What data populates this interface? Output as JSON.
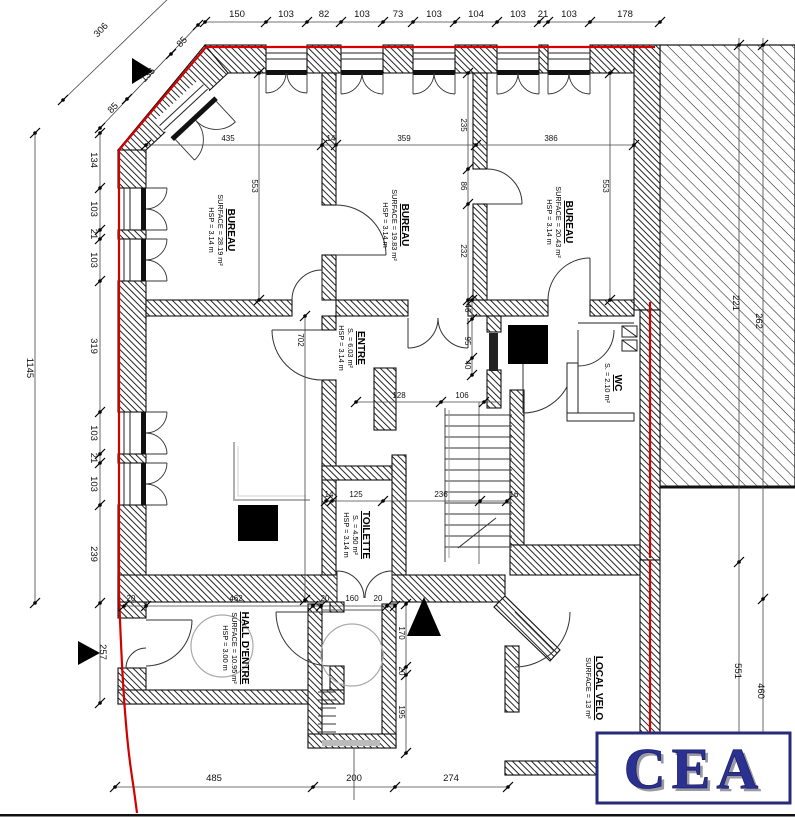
{
  "logo": {
    "text": "CEA",
    "color": "#2b3191",
    "border_color": "#272b7a",
    "shadow_color": "#9a9aa6"
  },
  "accent_colors": {
    "boundary_red": "#d40000",
    "line_black": "#111111"
  },
  "rooms": [
    {
      "id": "bureau-1",
      "name": "BUREAU",
      "line2": "SURFACE = 28.19 m²",
      "line3": "HSP = 3.14 m",
      "x": 228,
      "y": 230
    },
    {
      "id": "bureau-2",
      "name": "BUREAU",
      "line2": "SURFACE = 19.83 m²",
      "line3": "HSP = 3.14 m",
      "x": 402,
      "y": 225
    },
    {
      "id": "bureau-3",
      "name": "BUREAU",
      "line2": "SURFACE = 20.43 m²",
      "line3": "HSP = 3.14 m",
      "x": 566,
      "y": 222
    },
    {
      "id": "entre",
      "name": "ENTRE",
      "line2": "S. = 6.03 m²",
      "line3": "HSP = 3.14 m",
      "x": 358,
      "y": 348
    },
    {
      "id": "wc",
      "name": "WC",
      "line2": "S. = 2.10 m²",
      "line3": "",
      "x": 615,
      "y": 383
    },
    {
      "id": "toilette",
      "name": "TOILETTE",
      "line2": "S. = 4.50 m²",
      "line3": "HSP = 3.14 m",
      "x": 363,
      "y": 535
    },
    {
      "id": "hall-entre",
      "name": "HALL D'ENTRE",
      "line2": "SURFACE = 10.95 m²",
      "line3": "HSP = 3.00 m",
      "x": 242,
      "y": 648
    },
    {
      "id": "local-velo",
      "name": "LOCAL VELO",
      "line2": "SURFACE = 13 m²",
      "line3": "",
      "x": 596,
      "y": 688
    }
  ],
  "dim_labels": {
    "top": [
      {
        "t": "150",
        "x": 237,
        "y": 17
      },
      {
        "t": "103",
        "x": 286,
        "y": 17
      },
      {
        "t": "82",
        "x": 324,
        "y": 17
      },
      {
        "t": "103",
        "x": 362,
        "y": 17
      },
      {
        "t": "73",
        "x": 398,
        "y": 17
      },
      {
        "t": "103",
        "x": 434,
        "y": 17
      },
      {
        "t": "104",
        "x": 476,
        "y": 17
      },
      {
        "t": "103",
        "x": 518,
        "y": 17
      },
      {
        "t": "21",
        "x": 543,
        "y": 17
      },
      {
        "t": "103",
        "x": 569,
        "y": 17
      },
      {
        "t": "178",
        "x": 625,
        "y": 17
      }
    ],
    "left": [
      {
        "t": "134",
        "x": 91,
        "y": 160,
        "r": 90
      },
      {
        "t": "103",
        "x": 91,
        "y": 209,
        "r": 90
      },
      {
        "t": "21",
        "x": 91,
        "y": 234,
        "r": 90
      },
      {
        "t": "103",
        "x": 91,
        "y": 260,
        "r": 90
      },
      {
        "t": "319",
        "x": 91,
        "y": 346,
        "r": 90
      },
      {
        "t": "103",
        "x": 91,
        "y": 433,
        "r": 90
      },
      {
        "t": "21",
        "x": 91,
        "y": 458,
        "r": 90
      },
      {
        "t": "103",
        "x": 91,
        "y": 484,
        "r": 90
      },
      {
        "t": "239",
        "x": 91,
        "y": 554,
        "r": 90
      },
      {
        "t": "257",
        "x": 100,
        "y": 652,
        "r": 90
      },
      {
        "t": "1145",
        "x": 27,
        "y": 368,
        "r": 90
      }
    ],
    "diagonal": [
      {
        "t": "306",
        "x": 103,
        "y": 32,
        "r": -46
      },
      {
        "t": "85",
        "x": 184,
        "y": 44,
        "r": -46
      },
      {
        "t": "136",
        "x": 150,
        "y": 77,
        "r": -46
      },
      {
        "t": "85",
        "x": 115,
        "y": 110,
        "r": -46
      }
    ],
    "bottom": [
      {
        "t": "485",
        "x": 214,
        "y": 781
      },
      {
        "t": "200",
        "x": 354,
        "y": 781
      },
      {
        "t": "274",
        "x": 451,
        "y": 781
      }
    ],
    "right": [
      {
        "t": "221",
        "x": 733,
        "y": 303,
        "r": 90
      },
      {
        "t": "262",
        "x": 756,
        "y": 321,
        "r": 90
      },
      {
        "t": "551",
        "x": 735,
        "y": 671,
        "r": 90
      },
      {
        "t": "460",
        "x": 758,
        "y": 691,
        "r": 90
      }
    ],
    "interior": [
      {
        "t": "435",
        "x": 228,
        "y": 141
      },
      {
        "t": "14",
        "x": 331,
        "y": 141
      },
      {
        "t": "359",
        "x": 404,
        "y": 141
      },
      {
        "t": "386",
        "x": 551,
        "y": 141
      },
      {
        "t": "553",
        "x": 252,
        "y": 186,
        "r": 90
      },
      {
        "t": "553",
        "x": 603,
        "y": 186,
        "r": 90
      },
      {
        "t": "235",
        "x": 461,
        "y": 125,
        "r": 90
      },
      {
        "t": "86",
        "x": 461,
        "y": 186,
        "r": 90
      },
      {
        "t": "232",
        "x": 461,
        "y": 251,
        "r": 90
      },
      {
        "t": "702",
        "x": 298,
        "y": 340,
        "r": 90
      },
      {
        "t": "46",
        "x": 465,
        "y": 308,
        "r": 90
      },
      {
        "t": "95",
        "x": 465,
        "y": 341,
        "r": 90
      },
      {
        "t": "40",
        "x": 465,
        "y": 365,
        "r": 90
      },
      {
        "t": "128",
        "x": 399,
        "y": 398
      },
      {
        "t": "106",
        "x": 462,
        "y": 398
      },
      {
        "t": "14",
        "x": 329,
        "y": 497
      },
      {
        "t": "125",
        "x": 356,
        "y": 497
      },
      {
        "t": "236",
        "x": 441,
        "y": 497
      },
      {
        "t": "16",
        "x": 514,
        "y": 497
      },
      {
        "t": "20",
        "x": 131,
        "y": 601
      },
      {
        "t": "462",
        "x": 236,
        "y": 601
      },
      {
        "t": "20",
        "x": 325,
        "y": 601
      },
      {
        "t": "160",
        "x": 352,
        "y": 601
      },
      {
        "t": "20",
        "x": 378,
        "y": 601
      },
      {
        "t": "170",
        "x": 399,
        "y": 633,
        "r": 90
      },
      {
        "t": "20",
        "x": 399,
        "y": 671,
        "r": 90
      },
      {
        "t": "195",
        "x": 399,
        "y": 712,
        "r": 90
      }
    ]
  }
}
